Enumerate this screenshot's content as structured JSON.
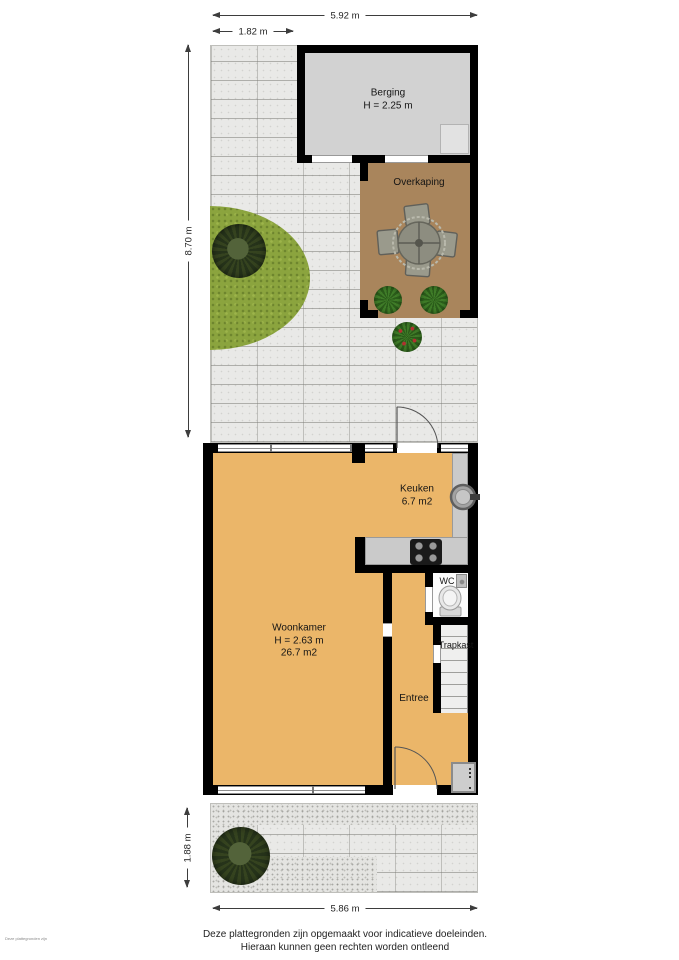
{
  "dimensions": {
    "top_total": "5.92 m",
    "top_left": "1.82 m",
    "garden_depth": "8.70 m",
    "front_depth": "1.88 m",
    "bottom_total": "5.86 m"
  },
  "rooms": {
    "berging": {
      "label": "Berging",
      "height": "H = 2.25 m"
    },
    "overkaping": {
      "label": "Overkaping"
    },
    "keuken": {
      "label": "Keuken",
      "area": "6.7 m2"
    },
    "wc": {
      "label": "WC"
    },
    "woonkamer": {
      "label": "Woonkamer",
      "height": "H = 2.63 m",
      "area": "26.7 m2"
    },
    "trapkast": {
      "label": "Trapkast"
    },
    "entree": {
      "label": "Entree"
    }
  },
  "footer": {
    "line1": "Deze plattegronden zijn opgemaakt voor indicatieve doeleinden.",
    "line2": "Hieraan kunnen geen rechten worden ontleend"
  },
  "watermark": "Deze plattegronden zijn opgemaakt voor indicatieve doeleinden. Hieraan kunnen geen rechten worden ontleend",
  "colors": {
    "wall": "#000000",
    "floor": "#ebb669",
    "berging_floor": "#d2d2d2",
    "overkaping_floor": "#a9855c",
    "paving": "#e9e9e7",
    "grass": "#8ba43e",
    "tree": "#2c3a1e",
    "counter": "#cacaca"
  }
}
